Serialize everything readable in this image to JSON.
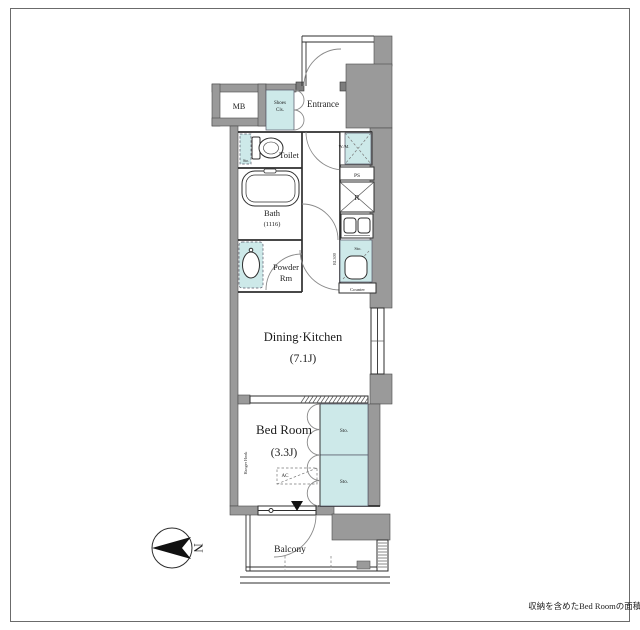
{
  "labels": {
    "mb": "MB",
    "shoes_line1": "Shoes",
    "shoes_line2": "Cls.",
    "entrance": "Entrance",
    "toilet": "Toilet",
    "toilet_storage": "Sto.",
    "washing_machine": "W./M.",
    "pipe_space": "PS",
    "refrigerator": "R",
    "bath_line1": "Bath",
    "bath_line2": "(1116)",
    "powder_line1": "Powder",
    "powder_line2": "Rm",
    "kitchen_storage": "Sto.",
    "counter": "Counter",
    "beam": "RL300",
    "dk_line1": "Dining·Kitchen",
    "dk_line2": "(7.1J)",
    "bedroom_line1": "Bed Room",
    "bedroom_line2": "(3.3J)",
    "storage_upper": "Sto.",
    "storage_lower": "Sto.",
    "hanger_hook": "Hanger Hook",
    "ac": "AC",
    "balcony": "Balcony",
    "north": "N",
    "footnote": "収納を含めたBed Roomの面積は4.4Jとなります"
  },
  "colors": {
    "wall": "#9a9a9a",
    "fixture_fill": "#cde9e9",
    "outline": "#333333",
    "background": "#ffffff"
  }
}
